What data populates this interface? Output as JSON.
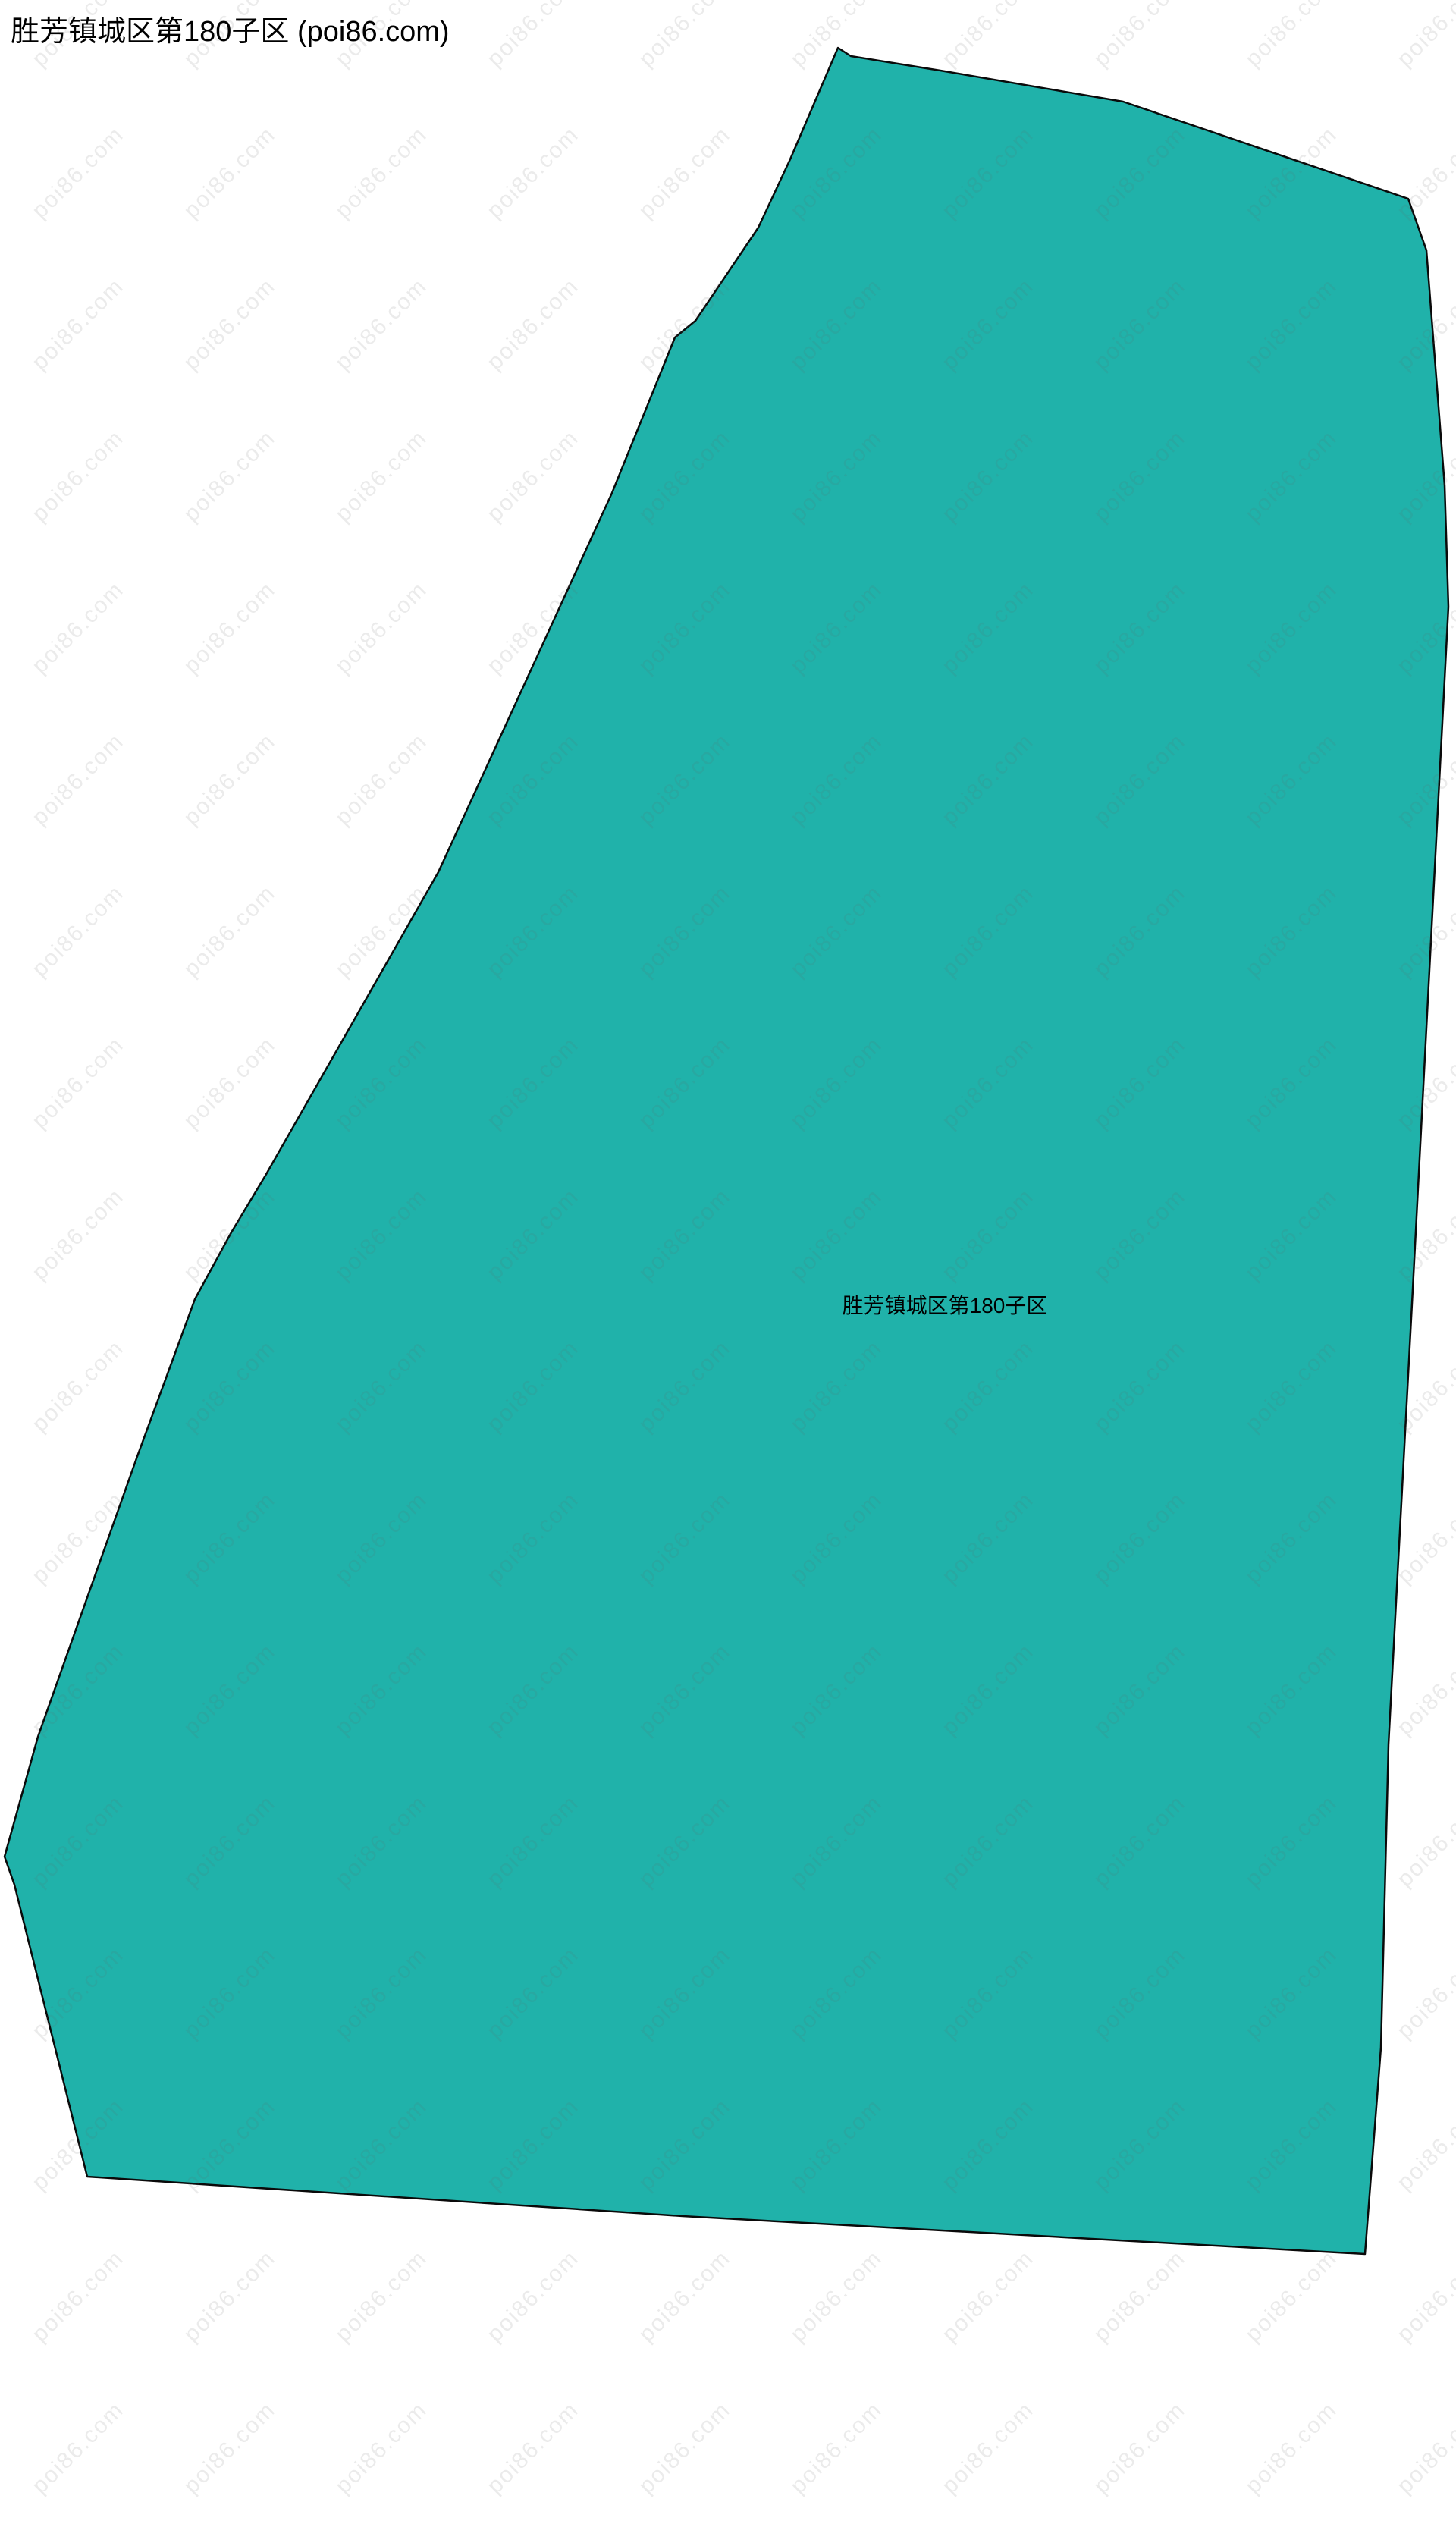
{
  "page": {
    "title": "胜芳镇城区第180子区 (poi86.com)"
  },
  "map": {
    "background_color": "#ffffff",
    "region": {
      "name": "胜芳镇城区第180子区",
      "label": "胜芳镇城区第180子区",
      "fill_color": "#20b2aa",
      "border_color": "#0a0a0a",
      "border_width": "2.5",
      "outline_points": "1105,63 1122,74 1240,93 1481,134 1857,262 1881,330 1905,640 1910,800 1863,1700 1831,2300 1821,2700 1800,2972 900,2922 115,2870 19,2485 6,2448 50,2290 180,1923 257,1713 305,1625 350,1550 578,1150 807,650 890,445 917,423 1000,300 1042,210"
    },
    "watermark": {
      "text": "poi86.com",
      "color": "rgba(100,100,100,0.13)"
    }
  }
}
